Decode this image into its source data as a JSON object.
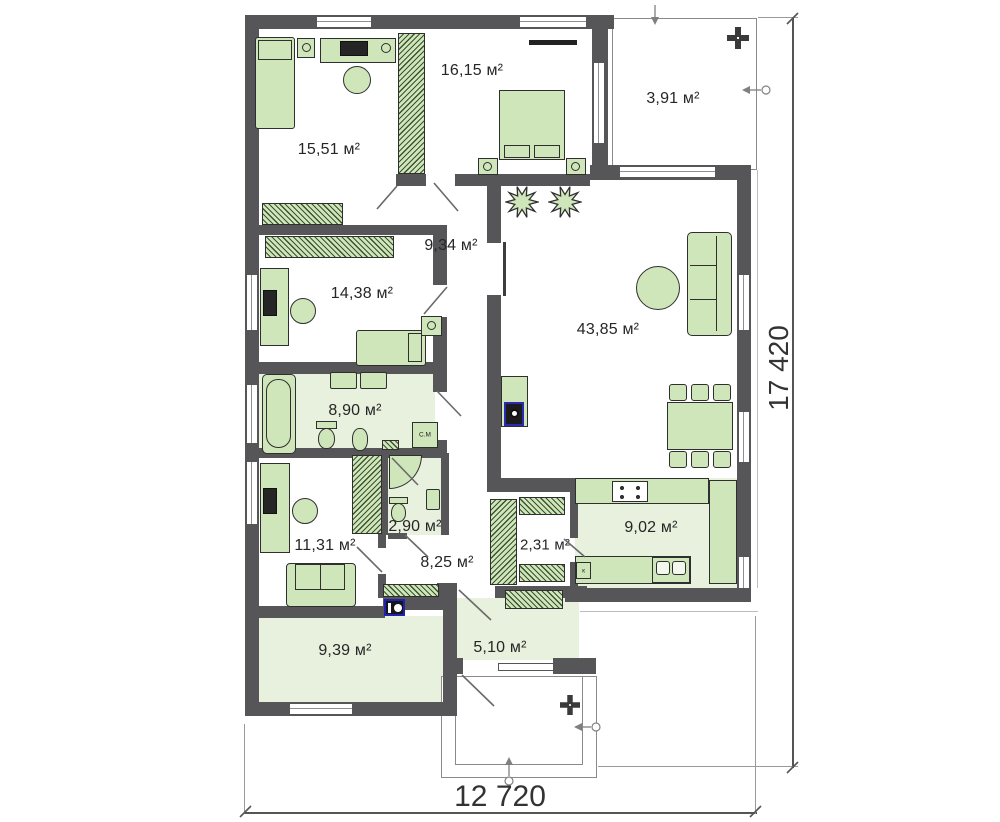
{
  "plan": {
    "rooms": [
      {
        "name": "bedroom-1",
        "area": "15,51 м²"
      },
      {
        "name": "bedroom-2",
        "area": "16,15 м²"
      },
      {
        "name": "terrace",
        "area": "3,91 м²"
      },
      {
        "name": "hallway",
        "area": "9,34 м²"
      },
      {
        "name": "bedroom-3",
        "area": "14,38 м²"
      },
      {
        "name": "living-room",
        "area": "43,85 м²"
      },
      {
        "name": "bathroom",
        "area": "8,90 м²"
      },
      {
        "name": "shower-room",
        "area": "2,90 м²"
      },
      {
        "name": "bedroom-4",
        "area": "11,31 м²"
      },
      {
        "name": "hall",
        "area": "8,25 м²"
      },
      {
        "name": "pantry",
        "area": "2,31 м²"
      },
      {
        "name": "kitchen",
        "area": "9,02 м²"
      },
      {
        "name": "utility-room",
        "area": "9,39 м²"
      },
      {
        "name": "entry-hall",
        "area": "5,10 м²"
      }
    ],
    "dimensions": {
      "width_label": "12 720",
      "height_label": "17 420"
    },
    "appliances": {
      "washing_machine_label": "С.М",
      "kitchen_unit_label": "к"
    },
    "colors": {
      "wall": "#565659",
      "furniture": "#cfe6ba",
      "floor_tint": "#e7f1dd",
      "accent_blue": "#2222b0"
    }
  }
}
